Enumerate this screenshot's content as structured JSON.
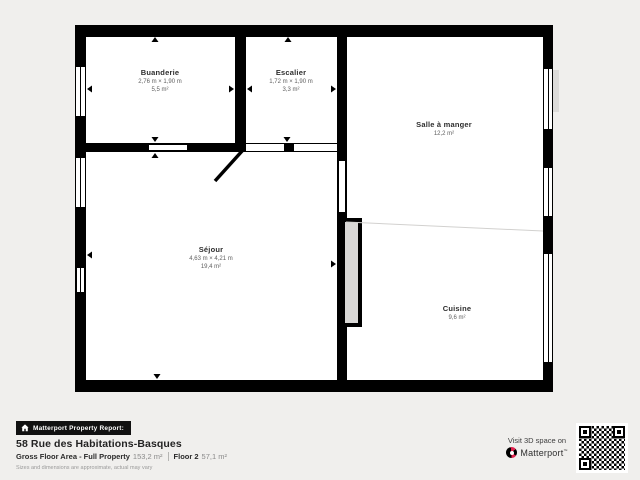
{
  "colors": {
    "wall": "#000000",
    "background": "#f0efed",
    "floor": "#ffffff",
    "faint_line": "#d2d1cf",
    "pad_gray": "#dcdbd9",
    "chimney_fill": "#d9d8d6",
    "accent_red": "#e0234e",
    "text_dark": "#232323",
    "text_mid": "#5f5f5f",
    "text_light": "#9a9a9a"
  },
  "rooms": [
    {
      "name": "Buanderie",
      "dimensions": "2,76 m × 1,90 m",
      "area": "5,5 m²"
    },
    {
      "name": "Escalier",
      "dimensions": "1,72 m × 1,90 m",
      "area": "3,3 m²"
    },
    {
      "name": "Salle à manger",
      "area": "12,2 m²"
    },
    {
      "name": "Séjour",
      "dimensions": "4,63 m × 4,21 m",
      "area": "19,4 m²"
    },
    {
      "name": "Cuisine",
      "area": "9,6 m²"
    }
  ],
  "report": {
    "badge_icon": "home-icon",
    "badge_label": "Matterport Property Report:",
    "address": "58 Rue des Habitations-Basques",
    "gross_label": "Gross Floor Area - Full Property",
    "gross_value": "153,2 m²",
    "floor_label": "Floor 2",
    "floor_value": "57,1 m²",
    "disclaimer": "Sizes and dimensions are approximate, actual may vary"
  },
  "promo": {
    "visit_label": "Visit 3D space on",
    "brand": "Matterport",
    "brand_mark": "™",
    "logo_icon": "matterport-logo",
    "qr_icon": "qr-code"
  }
}
